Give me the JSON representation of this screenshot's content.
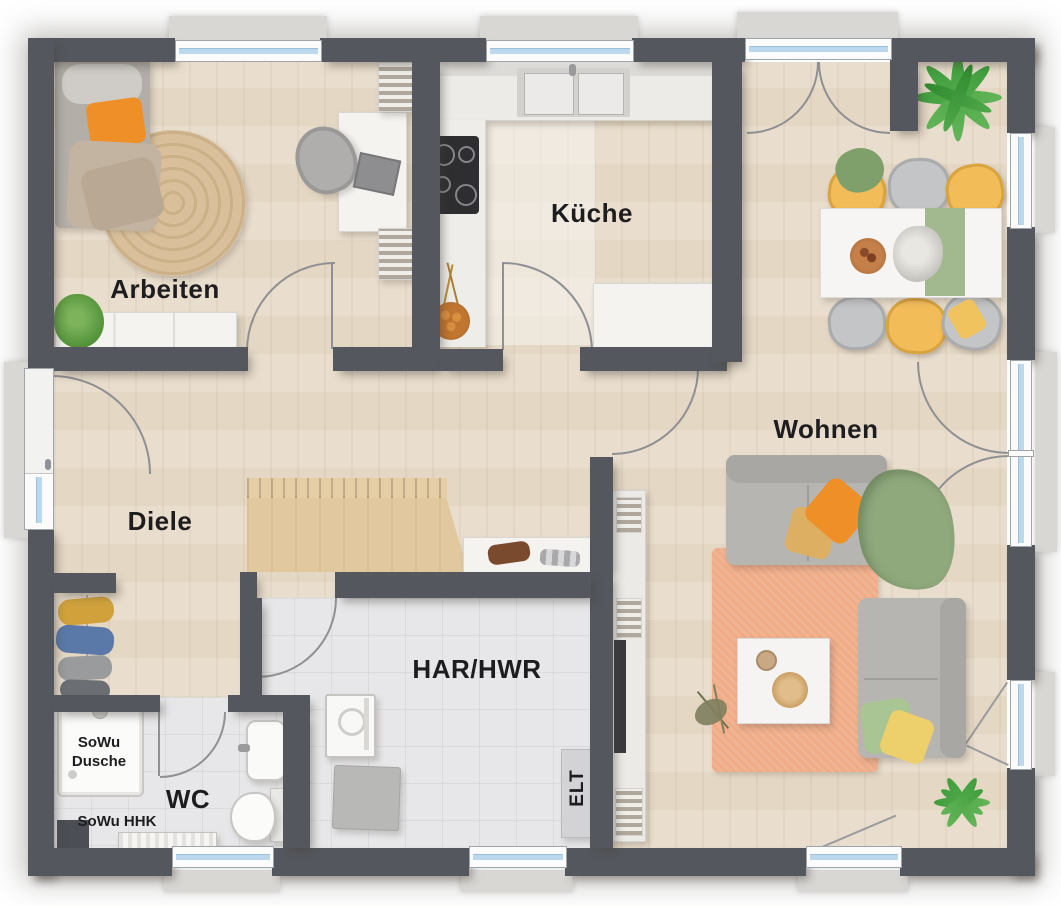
{
  "palette": {
    "wall": "#54585e",
    "background": "#ffffff",
    "wood_floor": "#e8dcca",
    "tile_floor": "#e7e7e9",
    "stairs_wood": "#e2c89e",
    "window_glass": "#bcd8ec",
    "sofa_gray": "#b7b5b2",
    "rug_salmon": "#efac87",
    "rug_jute": "#d9c09b",
    "accent_orange": "#ef8f27",
    "accent_yellow": "#f2bc59",
    "accent_green": "#8fa87c",
    "label_color": "#1d1d1f"
  },
  "rooms": {
    "arbeiten": {
      "label": "Arbeiten"
    },
    "kueche": {
      "label": "Küche"
    },
    "wohnen": {
      "label": "Wohnen"
    },
    "diele": {
      "label": "Diele"
    },
    "har_hwr": {
      "label": "HAR/HWR"
    },
    "wc": {
      "label": "WC"
    },
    "elt": {
      "label": "ELT"
    }
  },
  "annotations": {
    "shower_line1": "SoWu",
    "shower_line2": "Dusche",
    "heater_label": "SoWu HHK"
  }
}
